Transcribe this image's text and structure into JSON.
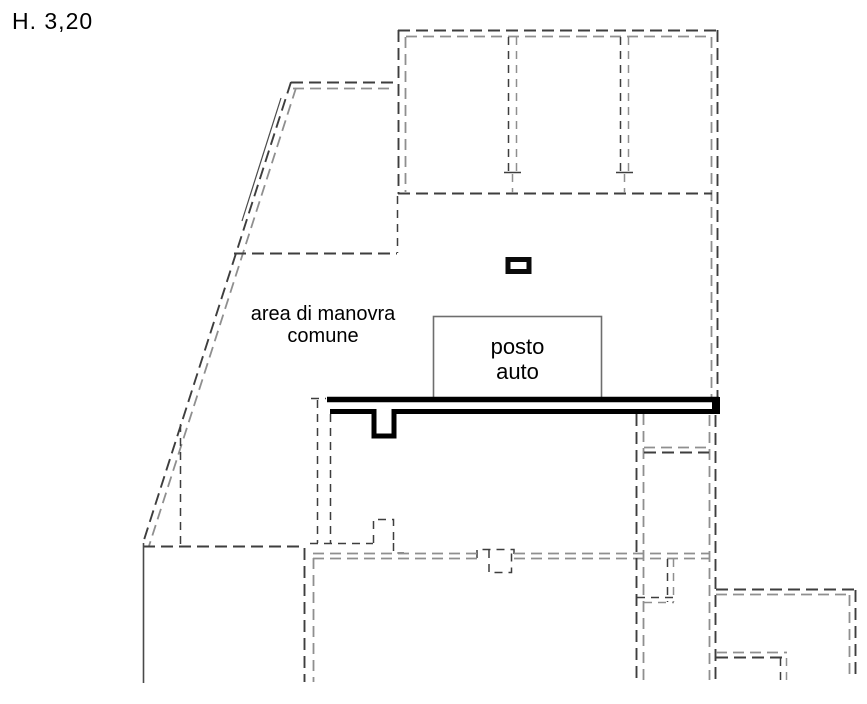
{
  "labels": {
    "height": "H. 3,20",
    "area_line1": "area di manovra",
    "area_line2": "comune",
    "parking_line1": "posto",
    "parking_line2": "auto"
  },
  "colors": {
    "background": "#ffffff",
    "text": "#000000",
    "line_black": "#000000",
    "line_dark": "#3e3e3e",
    "line_gray": "#8f8f8f",
    "line_solid": "#4a4a4a",
    "box_stroke": "#6e6e6e",
    "pillar_stroke": "#0a0a0a",
    "pillar_fill": "#ffffff"
  }
}
